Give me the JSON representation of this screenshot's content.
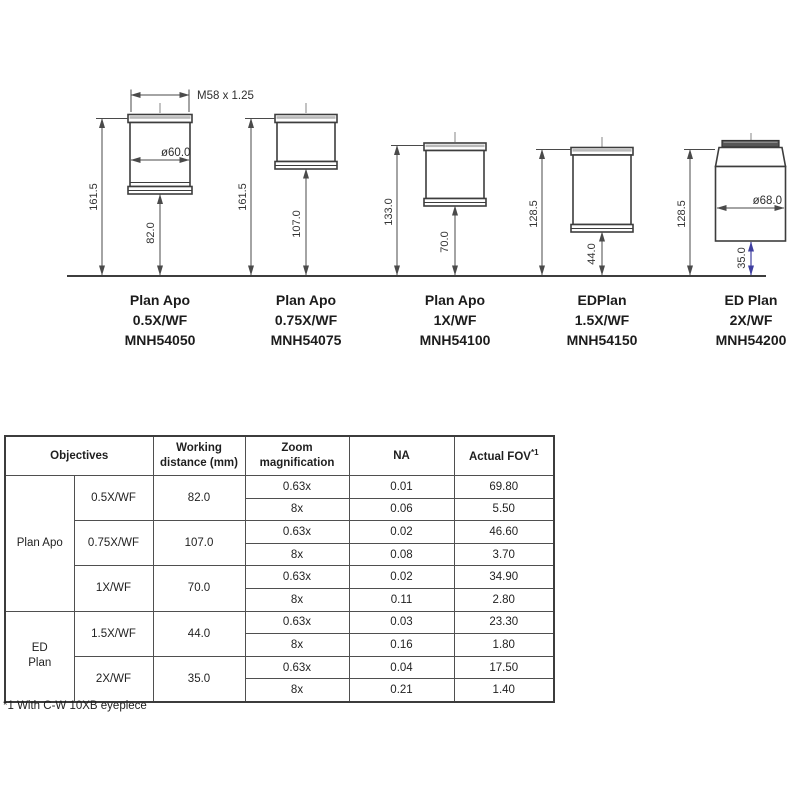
{
  "diagram": {
    "thread_label": "M58 x 1.25",
    "objectives": [
      {
        "name": "Plan Apo",
        "mag": "0.5X/WF",
        "model": "MNH54050",
        "overall_height": "161.5",
        "working_distance": "82.0",
        "diameter": "ø60.0"
      },
      {
        "name": "Plan Apo",
        "mag": "0.75X/WF",
        "model": "MNH54075",
        "overall_height": "161.5",
        "working_distance": "107.0"
      },
      {
        "name": "Plan Apo",
        "mag": "1X/WF",
        "model": "MNH54100",
        "overall_height": "133.0",
        "working_distance": "70.0"
      },
      {
        "name": "EDPlan",
        "mag": "1.5X/WF",
        "model": "MNH54150",
        "overall_height": "128.5",
        "working_distance": "44.0"
      },
      {
        "name": "ED Plan",
        "mag": "2X/WF",
        "model": "MNH54200",
        "overall_height": "128.5",
        "working_distance": "35.0",
        "diameter": "ø68.0"
      }
    ]
  },
  "table": {
    "header": {
      "objectives": "Objectives",
      "working_distance": "Working distance (mm)",
      "zoom_magnification": "Zoom magnification",
      "na": "NA",
      "actual_fov": "Actual FOV",
      "fov_footnote_marker": "*1"
    },
    "groups": [
      {
        "label": "Plan Apo",
        "objectives": [
          {
            "mag": "0.5X/WF",
            "working_distance": "82.0",
            "rows": [
              {
                "zoom": "0.63x",
                "na": "0.01",
                "fov": "69.80"
              },
              {
                "zoom": "8x",
                "na": "0.06",
                "fov": "5.50"
              }
            ]
          },
          {
            "mag": "0.75X/WF",
            "working_distance": "107.0",
            "rows": [
              {
                "zoom": "0.63x",
                "na": "0.02",
                "fov": "46.60"
              },
              {
                "zoom": "8x",
                "na": "0.08",
                "fov": "3.70"
              }
            ]
          },
          {
            "mag": "1X/WF",
            "working_distance": "70.0",
            "rows": [
              {
                "zoom": "0.63x",
                "na": "0.02",
                "fov": "34.90"
              },
              {
                "zoom": "8x",
                "na": "0.11",
                "fov": "2.80"
              }
            ]
          }
        ]
      },
      {
        "label": "ED Plan",
        "objectives": [
          {
            "mag": "1.5X/WF",
            "working_distance": "44.0",
            "rows": [
              {
                "zoom": "0.63x",
                "na": "0.03",
                "fov": "23.30"
              },
              {
                "zoom": "8x",
                "na": "0.16",
                "fov": "1.80"
              }
            ]
          },
          {
            "mag": "2X/WF",
            "working_distance": "35.0",
            "rows": [
              {
                "zoom": "0.63x",
                "na": "0.04",
                "fov": "17.50"
              },
              {
                "zoom": "8x",
                "na": "0.21",
                "fov": "1.40"
              }
            ]
          }
        ]
      }
    ]
  },
  "footnote": "*1 With C-W 10XB eyepiece",
  "colors": {
    "line": "#3d3d3d",
    "accent_blue": "#3f3fa0",
    "text": "#1f1f1f"
  }
}
